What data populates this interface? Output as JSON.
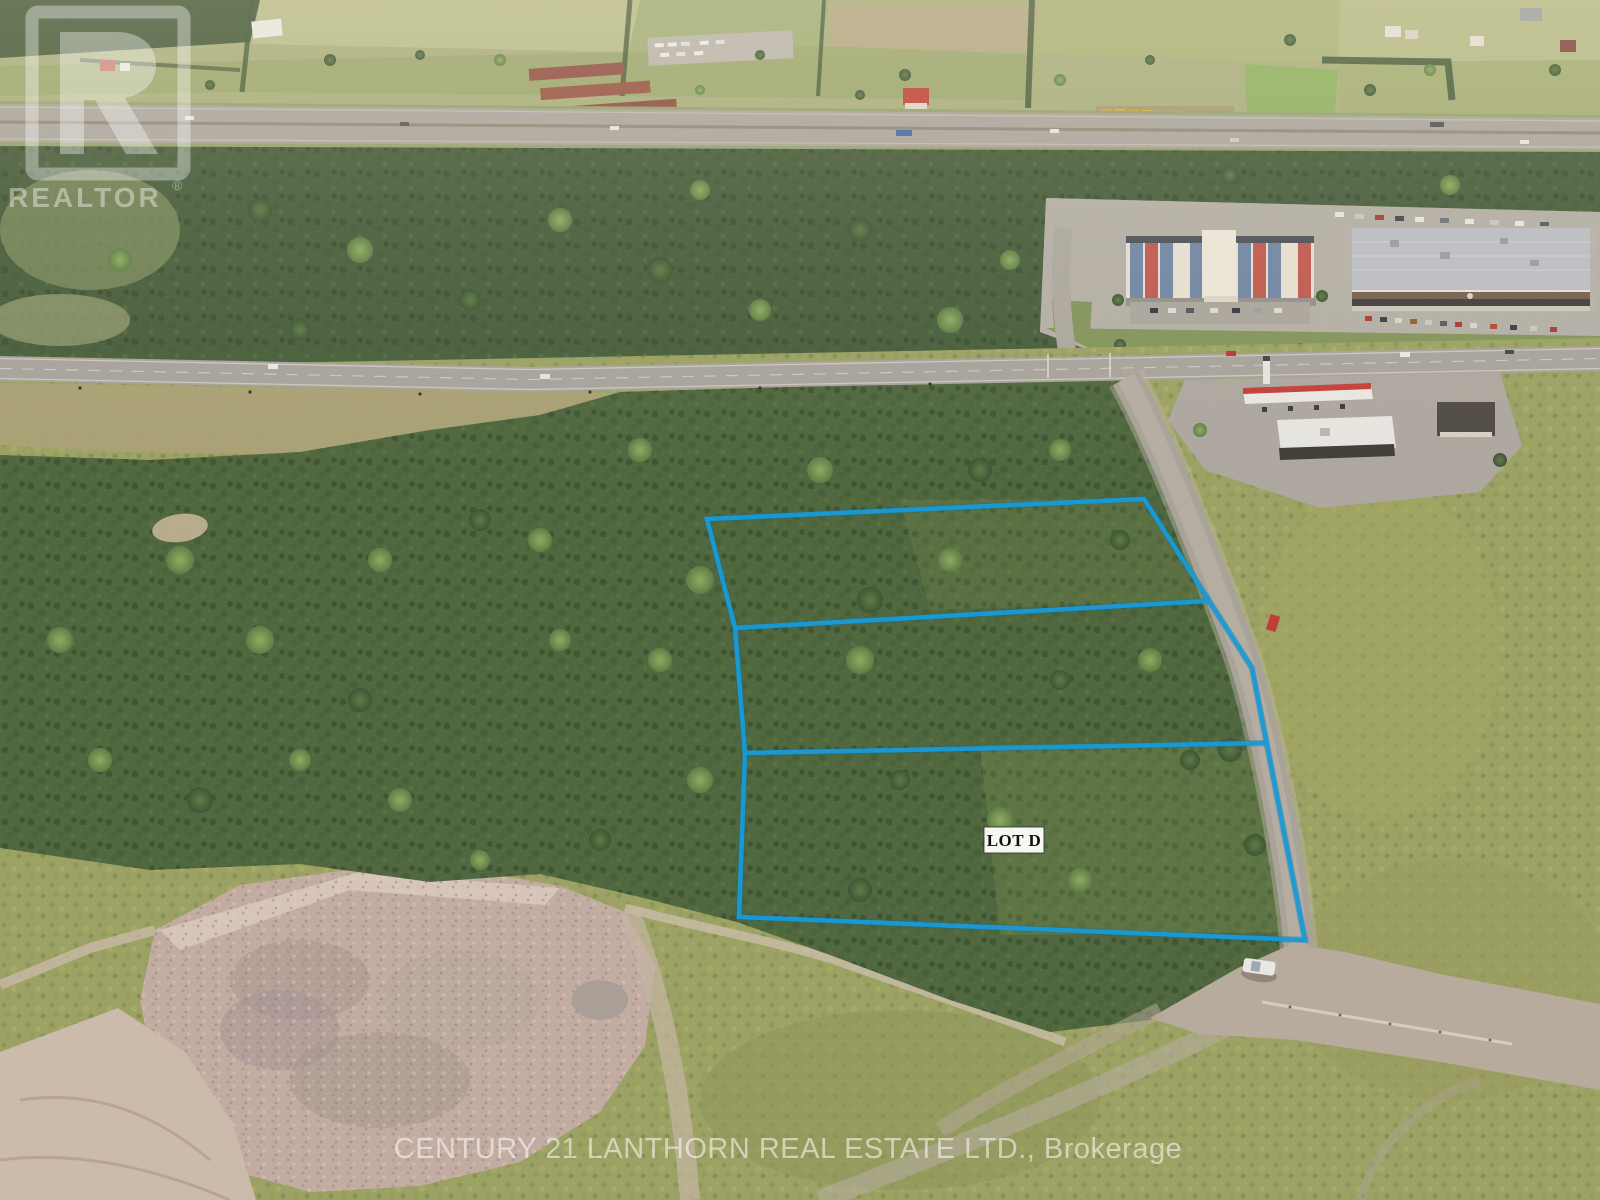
{
  "photo": {
    "kind": "aerial-drone-real-estate-photo",
    "width_px": 1600,
    "height_px": 1200
  },
  "watermarks": {
    "realtor_logo_text": "REALTOR",
    "registered_mark": "®",
    "brokerage_line": "CENTURY 21 LANTHORN REAL ESTATE LTD., Brokerage",
    "watermark_color": "#ffffff"
  },
  "lot_overlay": {
    "label": "LOT D",
    "line_color": "#189bd7",
    "outline_points": "707,519 1144,499 1252,668 1305,940 739,917 745,753 735,628",
    "north_divider_points": "735,628 1208,601",
    "south_divider_points": "745,753 1266,743"
  },
  "scene_colors": {
    "forest_green": "#4a6238",
    "field_green": "#a7ae7a",
    "asphalt_grey": "#a6a19a",
    "gravel_tan": "#c3aba0",
    "scrub_yellow_green": "#99a05f",
    "hotel_blue_panel": "#6d83a3",
    "hotel_red_panel": "#c0544b"
  }
}
